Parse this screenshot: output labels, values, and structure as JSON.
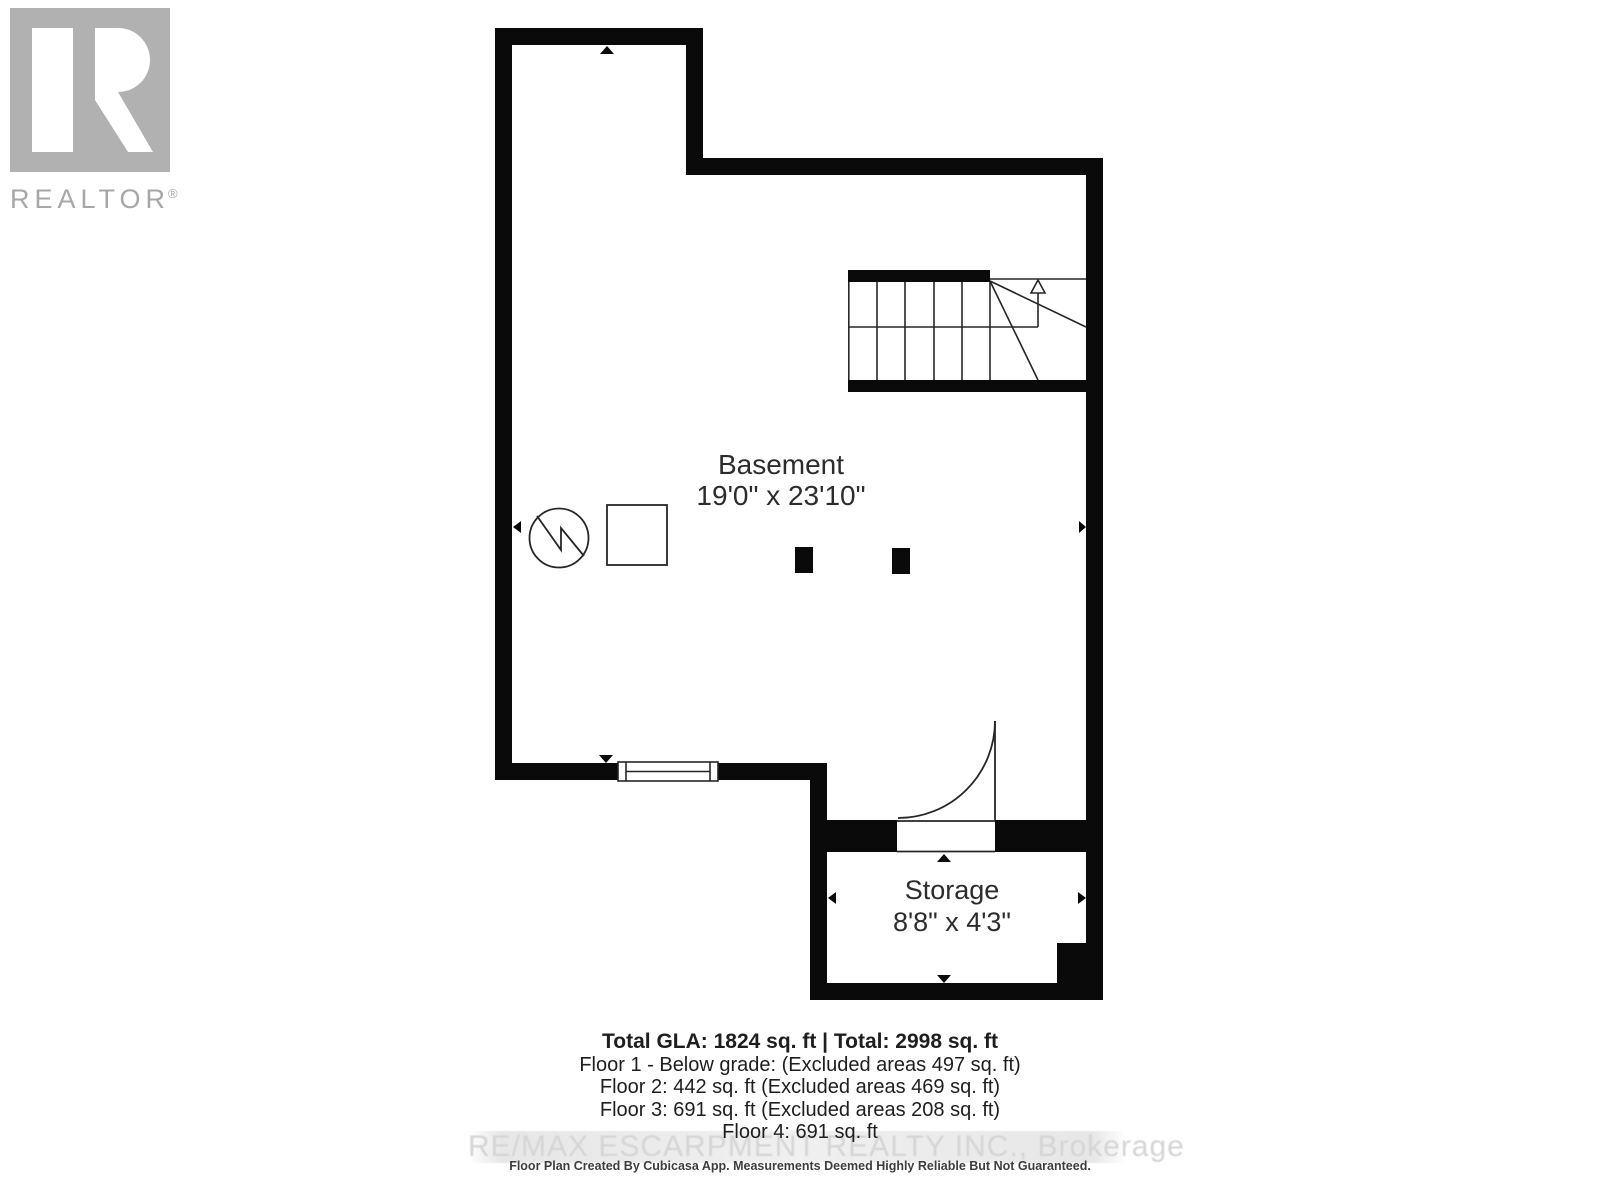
{
  "logo": {
    "brand": "REALTOR",
    "registered": "®"
  },
  "floor_plan": {
    "floor_label": "Basement floor plan",
    "rooms": [
      {
        "name": "Basement",
        "dimensions": "19'0\" x 23'10\""
      },
      {
        "name": "Storage",
        "dimensions": "8'8\" x 4'3\""
      }
    ]
  },
  "summary": {
    "total_line": "Total GLA: 1824 sq. ft | Total: 2998 sq. ft",
    "floors": [
      "Floor 1 - Below grade: (Excluded areas 497 sq. ft)",
      "Floor 2: 442 sq. ft (Excluded areas 469 sq. ft)",
      "Floor 3: 691 sq. ft (Excluded areas 208 sq. ft)",
      "Floor 4: 691 sq. ft"
    ]
  },
  "watermark": "RE/MAX ESCARPMENT REALTY INC., Brokerage",
  "disclaimer": "Floor Plan Created By Cubicasa App. Measurements Deemed Highly Reliable But Not Guaranteed.",
  "icons": {
    "realtor-logo-icon": "gray-square-white-R",
    "furnace-icon": "circle-with-zigzag",
    "water-tank-icon": "square-outline",
    "stairs-up-arrow-icon": "open-triangle-up-with-stem",
    "measure-arrow-icon": "small-solid-triangle"
  },
  "colors": {
    "wall": "#0a0a0a",
    "thin_line": "#262626",
    "room_text": "#2c2c2c",
    "logo_gray": "#b1b1b1",
    "watermark_text": "#d5d5d5",
    "watermark_band": "#e9e9e9"
  }
}
